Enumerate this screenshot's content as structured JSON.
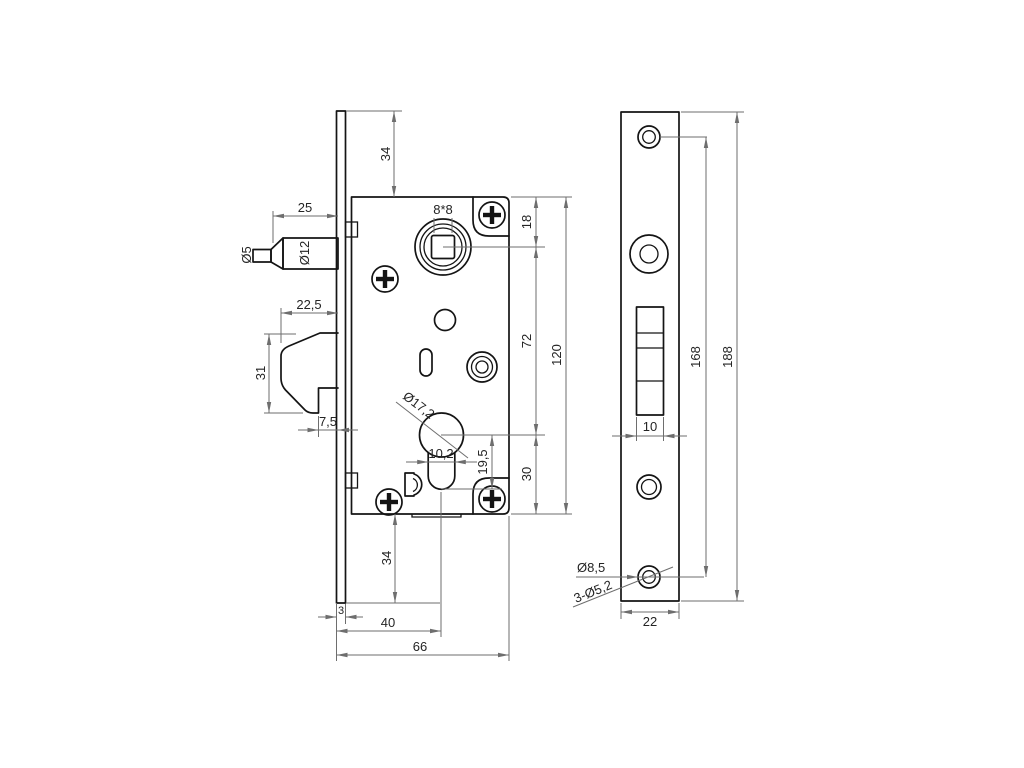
{
  "drawing": {
    "description": "Mortise door lock technical drawing, side view of lock case with front faceplate view",
    "background_color": "#ffffff",
    "outline_color": "#141414",
    "dimension_color": "#6e6e6e"
  },
  "side": {
    "dims": {
      "top_overhang": "34",
      "latch_length": "25",
      "latch_tip_dia": "Ø5",
      "latch_dia": "Ø12",
      "bolt_width": "22,5",
      "bolt_height": "31",
      "bolt_step": "7,5",
      "spindle_square": "8*8",
      "top_to_spindle": "18",
      "spindle_to_cyl": "72",
      "cyl_to_bottom": "30",
      "case_height": "120",
      "cyl_dia": "Ø17,2",
      "cyl_slot_width": "10,2",
      "cyl_slot_depth": "19,5",
      "bottom_overhang": "34",
      "plate_thickness": "3",
      "backset": "40",
      "case_depth": "66"
    }
  },
  "front": {
    "dims": {
      "screw_spacing": "168",
      "plate_length": "188",
      "cutout_width": "10",
      "plate_width": "22",
      "head_dia": "Ø8,5",
      "holes": "3-Ø5,2"
    }
  }
}
